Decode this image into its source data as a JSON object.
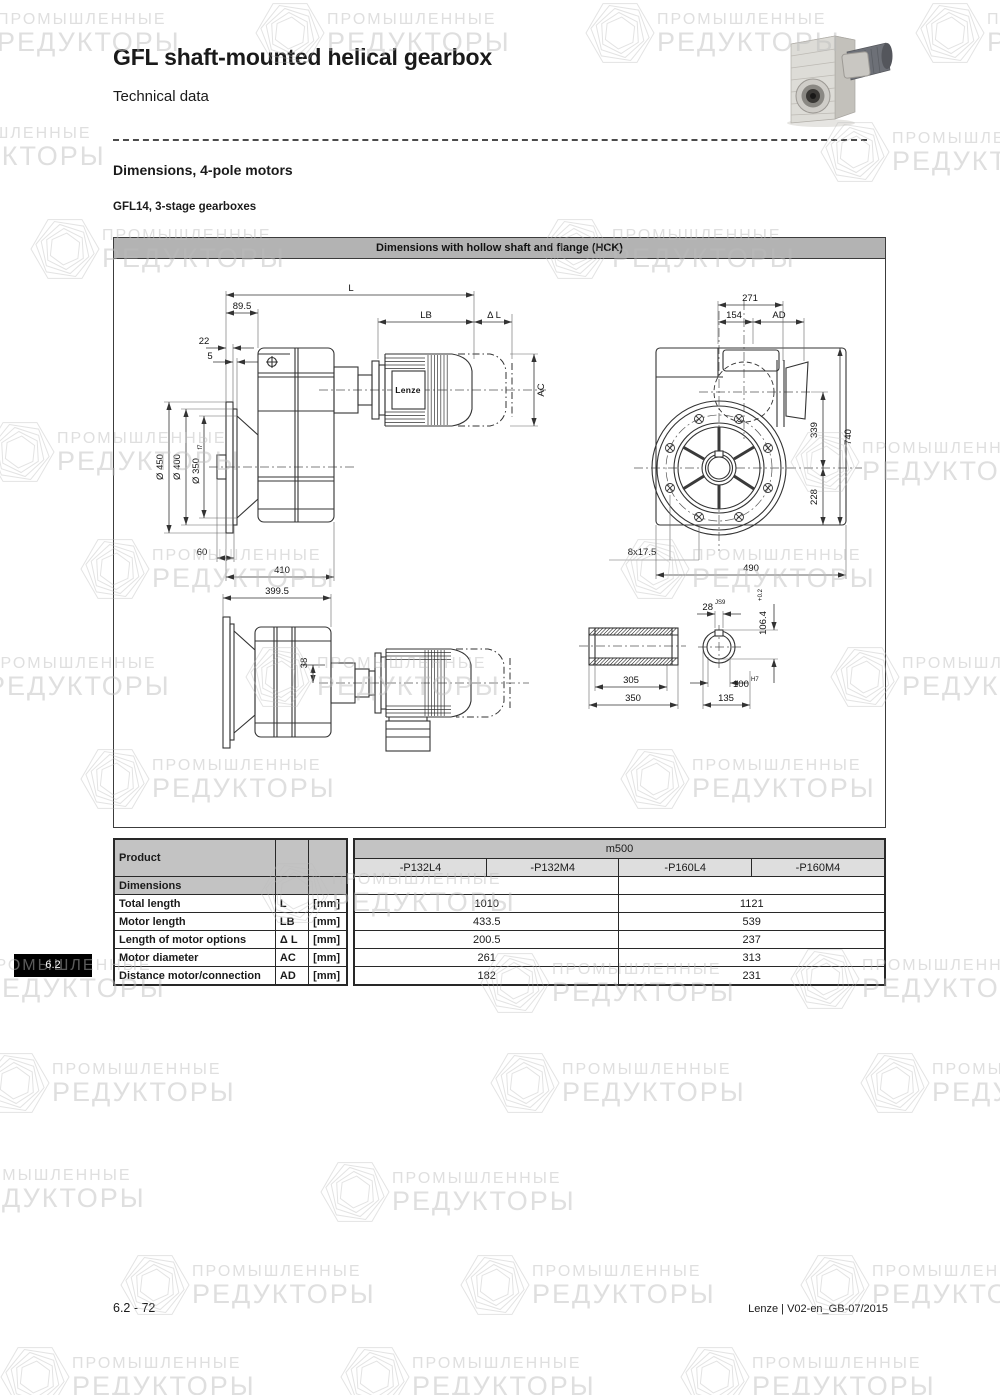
{
  "page": {
    "title": "GFL shaft-mounted helical gearbox",
    "subtitle": "Technical data",
    "section_heading": "Dimensions, 4-pole motors",
    "sub_heading": "GFL14, 3-stage gearboxes",
    "side_tab": "6.2",
    "footer_left": "6.2 - 72",
    "footer_right": "Lenze | V02-en_GB-07/2015"
  },
  "watermark": {
    "line1": "ПРОМЫШЛЕННЫЕ",
    "line2": "РЕДУКТОРЫ"
  },
  "figure": {
    "caption": "Dimensions with hollow shaft and flange (HCK)",
    "motor_brand": "Lenze",
    "dims": {
      "L": "L",
      "len895": "89.5",
      "len22": "22",
      "len5": "5",
      "LB": "LB",
      "dL": "Δ L",
      "AC": "AC",
      "dia450": "Ø 450",
      "dia400": "Ø 400",
      "dia350": "Ø 350",
      "dia350tol": "f7",
      "len60": "60",
      "len410": "410",
      "len3995": "399.5",
      "len38": "38",
      "len271": "271",
      "len154": "154",
      "AD": "AD",
      "len339": "339",
      "len740": "740",
      "len228": "228",
      "bolts": "8x17.5",
      "len490": "490",
      "len305": "305",
      "len350": "350",
      "key28": "28",
      "key28tol": "JS9",
      "len1064": "106.4",
      "len1064tol": "+0.2",
      "bore100": "100",
      "bore100tol": "H7",
      "len135": "135"
    }
  },
  "table": {
    "product_label": "Product",
    "group_header": "m500",
    "col_headers": [
      "-P132L4",
      "-P132M4",
      "-P160L4",
      "-P160M4"
    ],
    "section_label": "Dimensions",
    "rows": [
      {
        "label": "Total length",
        "symbol": "L",
        "unit": "[mm]",
        "v1": "1010",
        "v2": "1121"
      },
      {
        "label": "Motor length",
        "symbol": "LB",
        "unit": "[mm]",
        "v1": "433.5",
        "v2": "539"
      },
      {
        "label": "Length of motor options",
        "symbol": "Δ L",
        "unit": "[mm]",
        "v1": "200.5",
        "v2": "237"
      },
      {
        "label": "Motor diameter",
        "symbol": "AC",
        "unit": "[mm]",
        "v1": "261",
        "v2": "313"
      },
      {
        "label": "Distance motor/connection",
        "symbol": "AD",
        "unit": "[mm]",
        "v1": "182",
        "v2": "231"
      }
    ]
  }
}
